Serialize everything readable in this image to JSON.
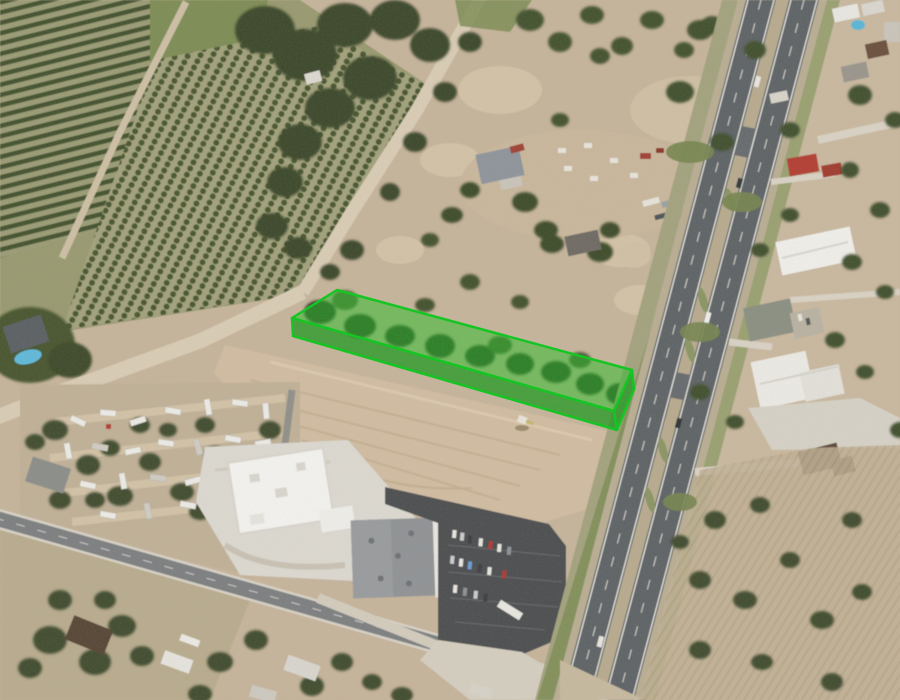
{
  "meta": {
    "title": "Oblique aerial photograph with highlighted land parcel",
    "view": "satellite / birds-eye",
    "visible_text": "none"
  },
  "parcel": {
    "name": "highlighted-parcel",
    "shape": "3D extruded quadrilateral highlight over brush strip",
    "top_points": "292,318 337,290 632,370 614,411",
    "front_wall_points": "292,318 614,411 617,430 293,336",
    "end_wall_points": "632,370 614,411 617,430 634,389",
    "stroke_color": "#0cc61c",
    "top_fill": "rgba(34,190,34,0.50)",
    "wall_fill": "rgba(20,150,22,0.72)",
    "stroke_width": "2.5"
  },
  "palette": {
    "scrub": "#c6b49b",
    "scrub_east": "#c9b89f",
    "field_olive": "#b8ab8e",
    "orchard_ground": "#98996f",
    "orchard_row_green": "#43512d",
    "grass": "#7d8c55",
    "dirt_road": "#d9ccb5",
    "tree_dark": "#3b4729",
    "cleared_lot": "#d0bca1",
    "asphalt_local": "#7b7e80",
    "asphalt_highway": "#5d6265",
    "median_tan": "#b7aa8e",
    "concrete": "#dcd9d1",
    "white_roof": "#f4f3f0",
    "gray_roof": "#8f9295",
    "parking_lot": "#4b4e50",
    "pool_blue": "#5fb9da",
    "red_roof": "#b23d31",
    "brown_roof": "#5f4a3c"
  },
  "features": {
    "northwest": "citrus orchard blocks with diagonal tree rows and access track",
    "north_center": "tree-lined dirt road descending to parcel tip; dense brush band",
    "center": "bright green highlighted parcel above large cleared dirt lot with excavator",
    "east": "divided highway with tan median, crossovers and vehicles",
    "southwest": "mobile home park with trailers among trees",
    "south": "convenience store and retail building with dark parking lot along local road",
    "southeast": "fallow row field with scattered brush",
    "far_east": "sheds, warehouses, farm houses and driveways"
  }
}
